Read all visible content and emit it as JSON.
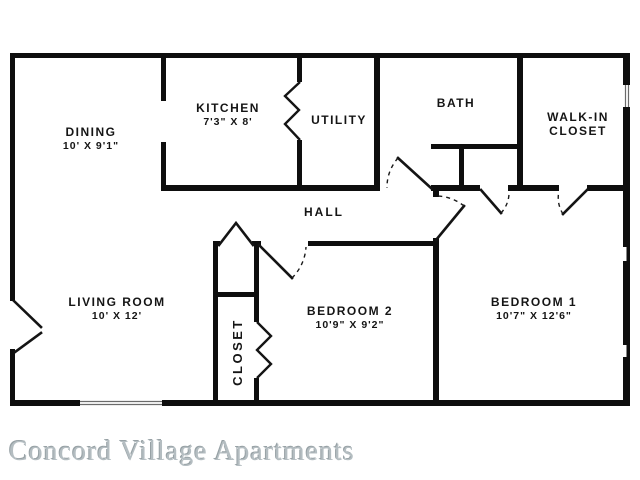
{
  "image": {
    "caption": "Concord Village Apartments"
  },
  "floorplan": {
    "rooms": {
      "dining": {
        "name": "DINING",
        "dimensions": "10' X 9'1\""
      },
      "kitchen": {
        "name": "KITCHEN",
        "dimensions": "7'3\" X 8'"
      },
      "utility": {
        "name": "UTILITY"
      },
      "bath": {
        "name": "BATH"
      },
      "walk_in_closet": {
        "line1": "WALK-IN",
        "line2": "CLOSET"
      },
      "hall": {
        "name": "HALL"
      },
      "living_room": {
        "name": "LIVING ROOM",
        "dimensions": "10' X 12'"
      },
      "bedroom2": {
        "name": "BEDROOM 2",
        "dimensions": "10'9\" X 9'2\""
      },
      "bedroom1": {
        "name": "BEDROOM 1",
        "dimensions": "10'7\" X 12'6\""
      },
      "closet": {
        "name": "CLOSET"
      }
    },
    "colors": {
      "wall": "#0e0e0e",
      "background": "#ffffff",
      "caption_gray": "#b4bdc1"
    }
  }
}
